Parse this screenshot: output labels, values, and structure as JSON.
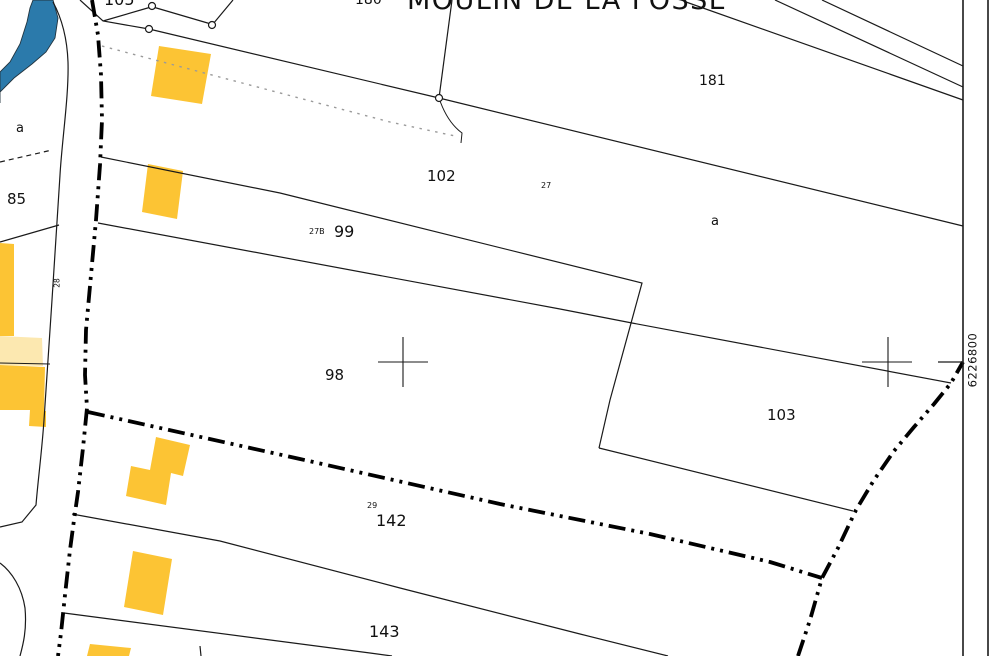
{
  "map": {
    "place_title": "MOULIN DE LA FOSSE",
    "grid_label": "6226800",
    "parcel_labels": {
      "p105": "105",
      "p180": "180",
      "p181": "181",
      "p102": "102",
      "p99": "99",
      "p98": "98",
      "p103": "103",
      "p142": "142",
      "p143": "143",
      "p85": "85"
    },
    "sub_labels": {
      "a_right": "a",
      "a_left": "a",
      "n27": "27",
      "n27b": "27B",
      "n28": "28",
      "n29": "29"
    },
    "colors": {
      "building": "#fcc434",
      "building_light": "#fce8b0",
      "water": "#2b7aab",
      "water_edge": "#1d3a4a",
      "line": "#1a1a1a",
      "boundary": "#000000",
      "dashed_path": "#9a9a9a"
    }
  }
}
